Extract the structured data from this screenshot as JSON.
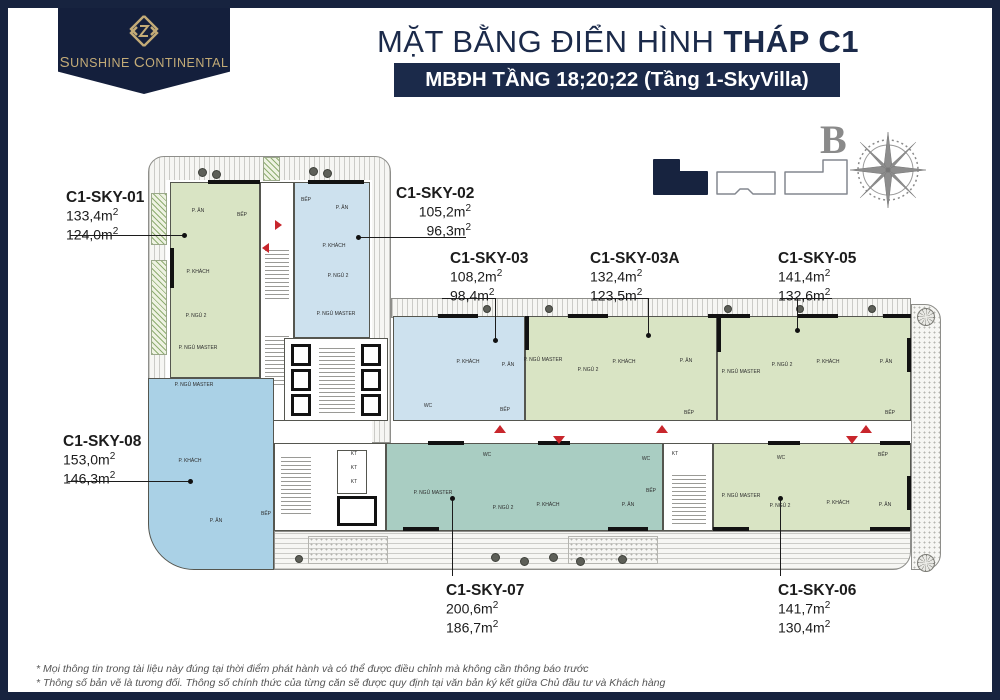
{
  "logo": {
    "brand": "Sunshine Continental",
    "brand_html_first": "SUNSHINE",
    "brand_html_second": "CONTINENTAL"
  },
  "header": {
    "title_regular": "MẶT BẰNG ĐIỂN HÌNH ",
    "title_bold": "THÁP C1",
    "subtitle": "MBĐH TẦNG 18;20;22 (Tầng 1-SkyVilla)"
  },
  "compass": {
    "north_label": "B"
  },
  "colors": {
    "navy": "#17233f",
    "gold": "#c3ab77",
    "unit_green": "#d9e4c4",
    "unit_pale_blue": "#cde1ee",
    "unit_blue": "#aad1e6",
    "unit_teal": "#a9cdc2",
    "red_marker": "#c8262c",
    "compass_gray": "#8a8a8a"
  },
  "units": [
    {
      "id": "C1-SKY-01",
      "area1": "133,4m2",
      "area2": "124,0m2",
      "x": 58,
      "y": 180,
      "w": 120,
      "align": "left",
      "leader": {
        "type": "h",
        "x": 62,
        "y": 227,
        "len": 114
      },
      "dot": {
        "x": 174,
        "y": 225
      }
    },
    {
      "id": "C1-SKY-02",
      "area1": "105,2m2",
      "area2": "96,3m2",
      "x": 388,
      "y": 176,
      "w": 75,
      "align": "right",
      "leader": {
        "type": "h",
        "x": 350,
        "y": 229,
        "len": 108
      },
      "dot": {
        "x": 348,
        "y": 227
      }
    },
    {
      "id": "C1-SKY-03",
      "area1": "108,2m2",
      "area2": "98,4m2",
      "x": 442,
      "y": 241,
      "w": 120,
      "align": "left",
      "leader": {
        "type": "v",
        "x": 487,
        "y": 290,
        "len": 42
      },
      "dot": {
        "x": 485,
        "y": 330
      },
      "bracket": {
        "x": 434,
        "y": 290,
        "len": 54
      }
    },
    {
      "id": "C1-SKY-03A",
      "area1": "132,4m2",
      "area2": "123,5m2",
      "x": 582,
      "y": 241,
      "w": 120,
      "align": "left",
      "leader": {
        "type": "v",
        "x": 640,
        "y": 290,
        "len": 37
      },
      "dot": {
        "x": 638,
        "y": 325
      },
      "bracket": {
        "x": 585,
        "y": 290,
        "len": 56
      }
    },
    {
      "id": "C1-SKY-05",
      "area1": "141,4m2",
      "area2": "132,6m2",
      "x": 770,
      "y": 241,
      "w": 120,
      "align": "left",
      "leader": {
        "type": "v",
        "x": 789,
        "y": 290,
        "len": 32
      },
      "dot": {
        "x": 787,
        "y": 320
      },
      "bracket": {
        "x": 772,
        "y": 290,
        "len": 52
      }
    },
    {
      "id": "C1-SKY-08",
      "area1": "153,0m2",
      "area2": "146,3m2",
      "x": 55,
      "y": 424,
      "w": 120,
      "align": "left",
      "leader": {
        "type": "h",
        "x": 60,
        "y": 473,
        "len": 122
      },
      "dot": {
        "x": 180,
        "y": 471
      }
    },
    {
      "id": "C1-SKY-07",
      "area1": "200,6m2",
      "area2": "186,7m2",
      "x": 438,
      "y": 573,
      "w": 120,
      "align": "left",
      "leader": {
        "type": "v",
        "x": 444,
        "y": 490,
        "len": 78
      },
      "dot": {
        "x": 442,
        "y": 488
      }
    },
    {
      "id": "C1-SKY-06",
      "area1": "141,7m2",
      "area2": "130,4m2",
      "x": 770,
      "y": 573,
      "w": 120,
      "align": "left",
      "leader": {
        "type": "v",
        "x": 772,
        "y": 490,
        "len": 78
      },
      "dot": {
        "x": 770,
        "y": 488
      }
    }
  ],
  "rooms": [
    {
      "x": 190,
      "y": 203,
      "t": "P. ĂN"
    },
    {
      "x": 234,
      "y": 207,
      "t": "BẾP"
    },
    {
      "x": 190,
      "y": 264,
      "t": "P. KHÁCH"
    },
    {
      "x": 188,
      "y": 308,
      "t": "P. NGỦ 2"
    },
    {
      "x": 190,
      "y": 340,
      "t": "P. NGỦ MASTER"
    },
    {
      "x": 298,
      "y": 192,
      "t": "BẾP"
    },
    {
      "x": 334,
      "y": 200,
      "t": "P. ĂN"
    },
    {
      "x": 326,
      "y": 238,
      "t": "P. KHÁCH"
    },
    {
      "x": 330,
      "y": 268,
      "t": "P. NGỦ 2"
    },
    {
      "x": 328,
      "y": 306,
      "t": "P. NGỦ MASTER"
    },
    {
      "x": 186,
      "y": 377,
      "t": "P. NGỦ MASTER"
    },
    {
      "x": 182,
      "y": 453,
      "t": "P. KHÁCH"
    },
    {
      "x": 208,
      "y": 513,
      "t": "P. ĂN"
    },
    {
      "x": 258,
      "y": 506,
      "t": "BẾP"
    },
    {
      "x": 460,
      "y": 354,
      "t": "P. KHÁCH"
    },
    {
      "x": 500,
      "y": 357,
      "t": "P. ĂN"
    },
    {
      "x": 497,
      "y": 402,
      "t": "BẾP"
    },
    {
      "x": 420,
      "y": 398,
      "t": "WC"
    },
    {
      "x": 535,
      "y": 352,
      "t": "P. NGỦ MASTER"
    },
    {
      "x": 580,
      "y": 362,
      "t": "P. NGỦ 2"
    },
    {
      "x": 616,
      "y": 354,
      "t": "P. KHÁCH"
    },
    {
      "x": 678,
      "y": 353,
      "t": "P. ĂN"
    },
    {
      "x": 681,
      "y": 405,
      "t": "BẾP"
    },
    {
      "x": 733,
      "y": 364,
      "t": "P. NGỦ MASTER"
    },
    {
      "x": 774,
      "y": 357,
      "t": "P. NGỦ 2"
    },
    {
      "x": 820,
      "y": 354,
      "t": "P. KHÁCH"
    },
    {
      "x": 878,
      "y": 354,
      "t": "P. ĂN"
    },
    {
      "x": 882,
      "y": 405,
      "t": "BẾP"
    },
    {
      "x": 425,
      "y": 485,
      "t": "P. NGỦ MASTER"
    },
    {
      "x": 495,
      "y": 500,
      "t": "P. NGỦ 2"
    },
    {
      "x": 540,
      "y": 497,
      "t": "P. KHÁCH"
    },
    {
      "x": 620,
      "y": 497,
      "t": "P. ĂN"
    },
    {
      "x": 643,
      "y": 483,
      "t": "BẾP"
    },
    {
      "x": 479,
      "y": 447,
      "t": "WC"
    },
    {
      "x": 638,
      "y": 451,
      "t": "WC"
    },
    {
      "x": 733,
      "y": 488,
      "t": "P. NGỦ MASTER"
    },
    {
      "x": 772,
      "y": 498,
      "t": "P. NGỦ 2"
    },
    {
      "x": 830,
      "y": 495,
      "t": "P. KHÁCH"
    },
    {
      "x": 877,
      "y": 497,
      "t": "P. ĂN"
    },
    {
      "x": 875,
      "y": 447,
      "t": "BẾP"
    },
    {
      "x": 773,
      "y": 450,
      "t": "WC"
    },
    {
      "x": 346,
      "y": 446,
      "t": "KT"
    },
    {
      "x": 346,
      "y": 460,
      "t": "KT"
    },
    {
      "x": 346,
      "y": 474,
      "t": "KT"
    },
    {
      "x": 667,
      "y": 446,
      "t": "KT"
    }
  ],
  "notes": [
    "* Mọi thông tin trong tài liệu này đúng tại thời điểm phát hành và có thể được điều chỉnh mà không cần thông báo trước",
    "* Thông số bản vẽ là tương đối. Thông số chính thức của từng căn sẽ được quy định tại văn bản ký kết giữa Chủ đầu tư và Khách hàng"
  ]
}
